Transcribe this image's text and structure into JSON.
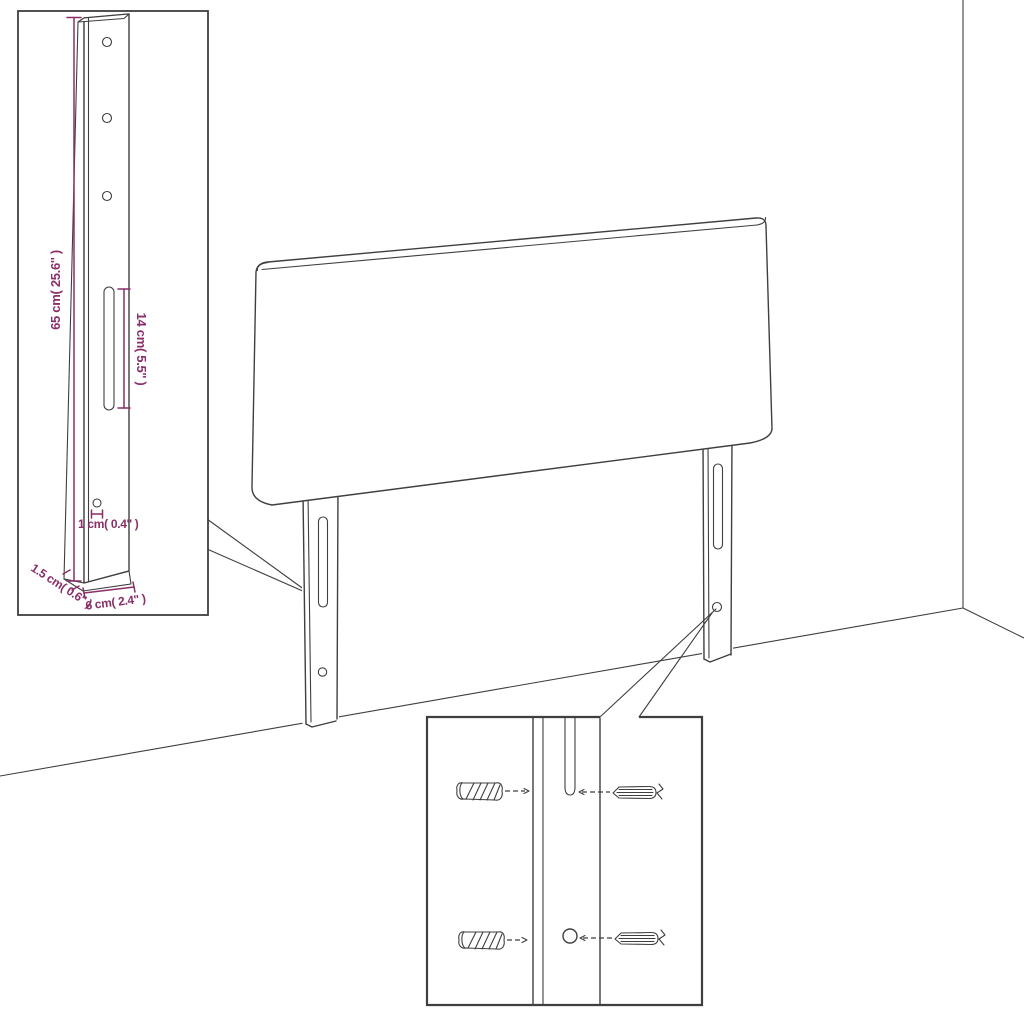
{
  "diagram": {
    "colors": {
      "background": "#ffffff",
      "line": "#3f3f3f",
      "dimension": "#8a2f68"
    },
    "dimensions": {
      "leg_height": "65 cm( 25.6'' )",
      "slot_length": "14 cm( 5.5'' )",
      "hole_diameter": "1 cm( 0.4'' )",
      "leg_thickness": "1.5 cm( 0.6'' )",
      "leg_width": "6 cm( 2.4'' )"
    }
  }
}
